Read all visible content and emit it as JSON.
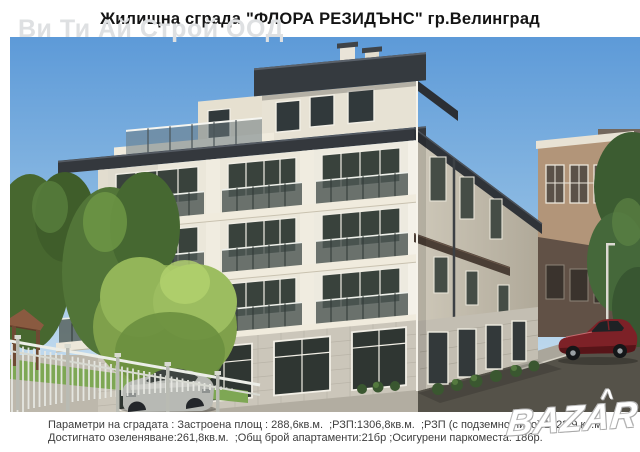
{
  "page": {
    "title": "Жилищна сграда \"ФЛОРА РЕЗИДЪНС\" гр.Велинград"
  },
  "watermarks": {
    "company": "Ви Ти Ай Строй ООД",
    "marketplace": "BAZAR",
    "marketplace_accent": "^"
  },
  "footer": {
    "line1": "Параметри на сградата : Застроена площ : 288,6кв.м.  ;РЗП:1306,8кв.м.  ;РЗП (с подземно ниво):1722,9 кв.м.",
    "line2": "Достигнато озеленяване:261,8кв.м.  ;Общ брой апартаменти:21бр ;Осигурени паркоместа: 18бр."
  },
  "scene": {
    "label": "Архитектурна визуализация на петeтажна жилищна сграда",
    "colors": {
      "sky_top": "#5d9ad8",
      "sky_bottom": "#d5e6f2",
      "facade": "#ebe7da",
      "roof": "#34383d",
      "stone_ground_floor": "#cbc6ba",
      "tan_building": "#b29579",
      "dark_building": "#73675c",
      "trees_green": "#527538",
      "bright_tree": "#8fb054",
      "road": "#555249",
      "red_car": "#7d2127",
      "silver_car": "#b7b9b4",
      "fence": "#e8e9e4"
    }
  }
}
